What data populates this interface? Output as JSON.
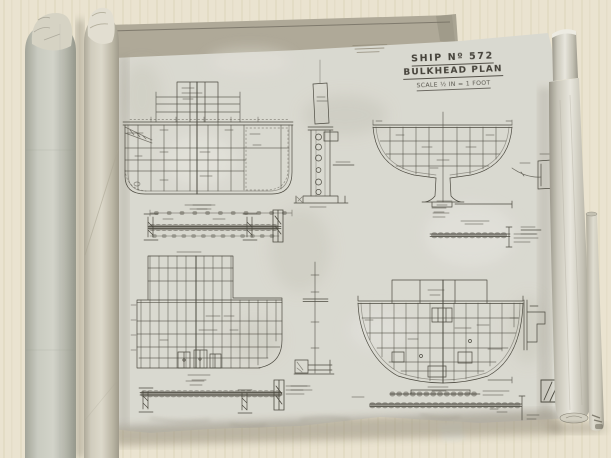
{
  "sheet": {
    "title_block": {
      "line1": "SHIP Nº 572",
      "line2": "BULKHEAD PLAN",
      "line3": "SCALE ½ IN = 1 FOOT"
    }
  },
  "palette": {
    "table": "#f1ead7",
    "sheet": "#e0dfd7",
    "sheet_back": "#b4ae9d",
    "ink": "#4e4c42",
    "roll": "#cfd0c6",
    "shadow": "#8a8271"
  }
}
